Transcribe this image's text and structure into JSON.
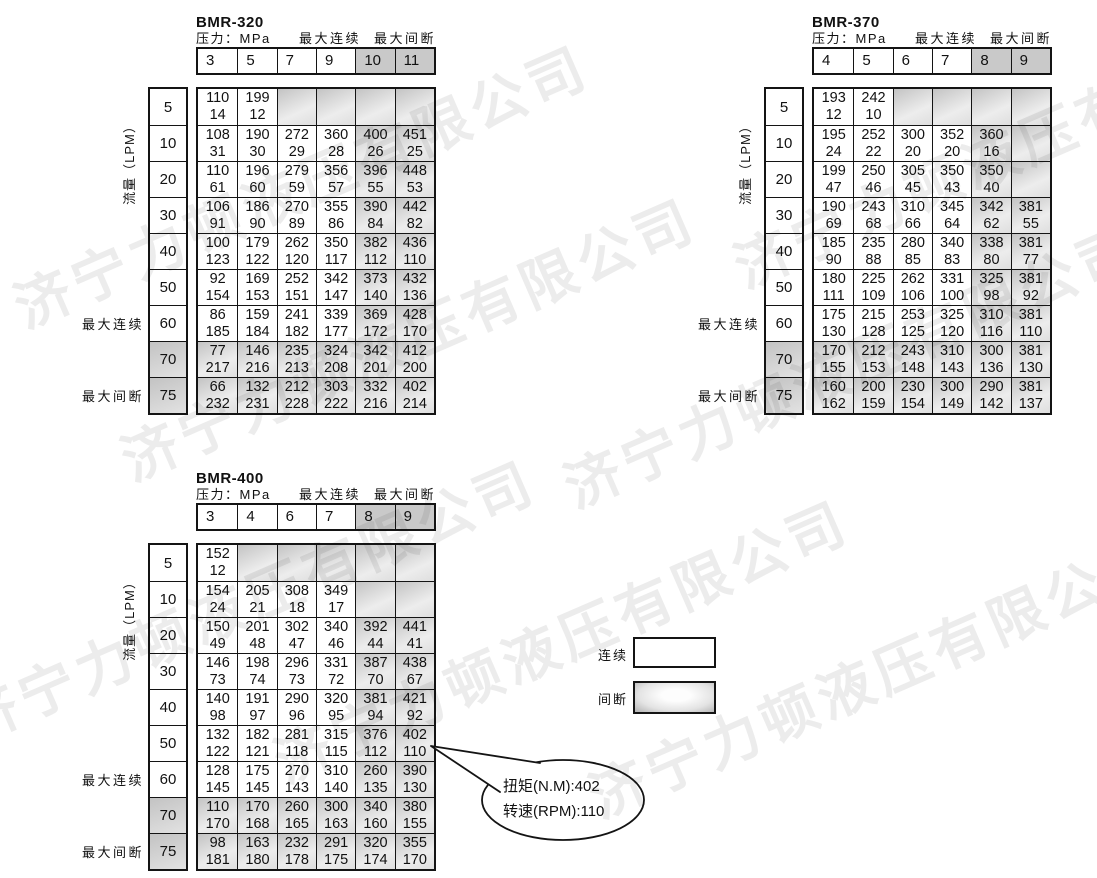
{
  "watermark": {
    "text": "济宁力顿液压有限公司"
  },
  "shared_labels": {
    "pressure_unit": "压力：MPa",
    "max_continuous": "最大连续",
    "max_intermittent": "最大间断",
    "flow_axis": "流量（LPM）"
  },
  "legend": {
    "continuous": "连续",
    "intermittent": "间断"
  },
  "callout": {
    "torque_line": "扭矩(N.M):402",
    "speed_line": "转速(RPM):110"
  },
  "tables": [
    {
      "title": "BMR-320",
      "pressure_columns": [
        "3",
        "5",
        "7",
        "9",
        "10",
        "11"
      ],
      "flow_rows": [
        "5",
        "10",
        "20",
        "30",
        "40",
        "50",
        "60",
        "70",
        "75"
      ],
      "shaded_columns_from": 4,
      "shaded_rows_from": 7,
      "cells": [
        [
          [
            "110",
            "14",
            0
          ],
          [
            "199",
            "12",
            0
          ],
          null,
          null,
          null,
          null
        ],
        [
          [
            "108",
            "31",
            0
          ],
          [
            "190",
            "30",
            0
          ],
          [
            "272",
            "29",
            0
          ],
          [
            "360",
            "28",
            0
          ],
          [
            "400",
            "26",
            1
          ],
          [
            "451",
            "25",
            1
          ]
        ],
        [
          [
            "110",
            "61",
            0
          ],
          [
            "196",
            "60",
            0
          ],
          [
            "279",
            "59",
            0
          ],
          [
            "356",
            "57",
            0
          ],
          [
            "396",
            "55",
            1
          ],
          [
            "448",
            "53",
            1
          ]
        ],
        [
          [
            "106",
            "91",
            0
          ],
          [
            "186",
            "90",
            0
          ],
          [
            "270",
            "89",
            0
          ],
          [
            "355",
            "86",
            0
          ],
          [
            "390",
            "84",
            1
          ],
          [
            "442",
            "82",
            1
          ]
        ],
        [
          [
            "100",
            "123",
            0
          ],
          [
            "179",
            "122",
            0
          ],
          [
            "262",
            "120",
            0
          ],
          [
            "350",
            "117",
            0
          ],
          [
            "382",
            "112",
            1
          ],
          [
            "436",
            "110",
            1
          ]
        ],
        [
          [
            "92",
            "154",
            0
          ],
          [
            "169",
            "153",
            0
          ],
          [
            "252",
            "151",
            0
          ],
          [
            "342",
            "147",
            0
          ],
          [
            "373",
            "140",
            1
          ],
          [
            "432",
            "136",
            1
          ]
        ],
        [
          [
            "86",
            "185",
            0
          ],
          [
            "159",
            "184",
            0
          ],
          [
            "241",
            "182",
            0
          ],
          [
            "339",
            "177",
            0
          ],
          [
            "369",
            "172",
            1
          ],
          [
            "428",
            "170",
            1
          ]
        ],
        [
          [
            "77",
            "217",
            1
          ],
          [
            "146",
            "216",
            1
          ],
          [
            "235",
            "213",
            1
          ],
          [
            "324",
            "208",
            1
          ],
          [
            "342",
            "201",
            1
          ],
          [
            "412",
            "200",
            1
          ]
        ],
        [
          [
            "66",
            "232",
            1
          ],
          [
            "132",
            "231",
            1
          ],
          [
            "212",
            "228",
            1
          ],
          [
            "303",
            "222",
            1
          ],
          [
            "332",
            "216",
            1
          ],
          [
            "402",
            "214",
            1
          ]
        ]
      ]
    },
    {
      "title": "BMR-370",
      "pressure_columns": [
        "4",
        "5",
        "6",
        "7",
        "8",
        "9"
      ],
      "flow_rows": [
        "5",
        "10",
        "20",
        "30",
        "40",
        "50",
        "60",
        "70",
        "75"
      ],
      "shaded_columns_from": 4,
      "shaded_rows_from": 7,
      "cells": [
        [
          [
            "193",
            "12",
            0
          ],
          [
            "242",
            "10",
            0
          ],
          null,
          null,
          null,
          null
        ],
        [
          [
            "195",
            "24",
            0
          ],
          [
            "252",
            "22",
            0
          ],
          [
            "300",
            "20",
            0
          ],
          [
            "352",
            "20",
            0
          ],
          [
            "360",
            "16",
            1
          ],
          null
        ],
        [
          [
            "199",
            "47",
            0
          ],
          [
            "250",
            "46",
            0
          ],
          [
            "305",
            "45",
            0
          ],
          [
            "350",
            "43",
            0
          ],
          [
            "350",
            "40",
            1
          ],
          null
        ],
        [
          [
            "190",
            "69",
            0
          ],
          [
            "243",
            "68",
            0
          ],
          [
            "310",
            "66",
            0
          ],
          [
            "345",
            "64",
            0
          ],
          [
            "342",
            "62",
            1
          ],
          [
            "381",
            "55",
            1
          ]
        ],
        [
          [
            "185",
            "90",
            0
          ],
          [
            "235",
            "88",
            0
          ],
          [
            "280",
            "85",
            0
          ],
          [
            "340",
            "83",
            0
          ],
          [
            "338",
            "80",
            1
          ],
          [
            "381",
            "77",
            1
          ]
        ],
        [
          [
            "180",
            "111",
            0
          ],
          [
            "225",
            "109",
            0
          ],
          [
            "262",
            "106",
            0
          ],
          [
            "331",
            "100",
            0
          ],
          [
            "325",
            "98",
            1
          ],
          [
            "381",
            "92",
            1
          ]
        ],
        [
          [
            "175",
            "130",
            0
          ],
          [
            "215",
            "128",
            0
          ],
          [
            "253",
            "125",
            0
          ],
          [
            "325",
            "120",
            0
          ],
          [
            "310",
            "116",
            1
          ],
          [
            "381",
            "110",
            1
          ]
        ],
        [
          [
            "170",
            "155",
            1
          ],
          [
            "212",
            "153",
            1
          ],
          [
            "243",
            "148",
            1
          ],
          [
            "310",
            "143",
            1
          ],
          [
            "300",
            "136",
            1
          ],
          [
            "381",
            "130",
            1
          ]
        ],
        [
          [
            "160",
            "162",
            1
          ],
          [
            "200",
            "159",
            1
          ],
          [
            "230",
            "154",
            1
          ],
          [
            "300",
            "149",
            1
          ],
          [
            "290",
            "142",
            1
          ],
          [
            "381",
            "137",
            1
          ]
        ]
      ]
    },
    {
      "title": "BMR-400",
      "pressure_columns": [
        "3",
        "4",
        "6",
        "7",
        "8",
        "9"
      ],
      "flow_rows": [
        "5",
        "10",
        "20",
        "30",
        "40",
        "50",
        "60",
        "70",
        "75"
      ],
      "shaded_columns_from": 4,
      "shaded_rows_from": 7,
      "cells": [
        [
          [
            "152",
            "12",
            0
          ],
          null,
          null,
          null,
          null,
          null
        ],
        [
          [
            "154",
            "24",
            0
          ],
          [
            "205",
            "21",
            0
          ],
          [
            "308",
            "18",
            0
          ],
          [
            "349",
            "17",
            0
          ],
          null,
          null
        ],
        [
          [
            "150",
            "49",
            0
          ],
          [
            "201",
            "48",
            0
          ],
          [
            "302",
            "47",
            0
          ],
          [
            "340",
            "46",
            0
          ],
          [
            "392",
            "44",
            1
          ],
          [
            "441",
            "41",
            1
          ]
        ],
        [
          [
            "146",
            "73",
            0
          ],
          [
            "198",
            "74",
            0
          ],
          [
            "296",
            "73",
            0
          ],
          [
            "331",
            "72",
            0
          ],
          [
            "387",
            "70",
            1
          ],
          [
            "438",
            "67",
            1
          ]
        ],
        [
          [
            "140",
            "98",
            0
          ],
          [
            "191",
            "97",
            0
          ],
          [
            "290",
            "96",
            0
          ],
          [
            "320",
            "95",
            0
          ],
          [
            "381",
            "94",
            1
          ],
          [
            "421",
            "92",
            1
          ]
        ],
        [
          [
            "132",
            "122",
            0
          ],
          [
            "182",
            "121",
            0
          ],
          [
            "281",
            "118",
            0
          ],
          [
            "315",
            "115",
            0
          ],
          [
            "376",
            "112",
            1
          ],
          [
            "402",
            "110",
            1
          ]
        ],
        [
          [
            "128",
            "145",
            0
          ],
          [
            "175",
            "145",
            0
          ],
          [
            "270",
            "143",
            0
          ],
          [
            "310",
            "140",
            0
          ],
          [
            "260",
            "135",
            1
          ],
          [
            "390",
            "130",
            1
          ]
        ],
        [
          [
            "110",
            "170",
            1
          ],
          [
            "170",
            "168",
            1
          ],
          [
            "260",
            "165",
            1
          ],
          [
            "300",
            "163",
            1
          ],
          [
            "340",
            "160",
            1
          ],
          [
            "380",
            "155",
            1
          ]
        ],
        [
          [
            "98",
            "181",
            1
          ],
          [
            "163",
            "180",
            1
          ],
          [
            "232",
            "178",
            1
          ],
          [
            "291",
            "175",
            1
          ],
          [
            "320",
            "174",
            1
          ],
          [
            "355",
            "170",
            1
          ]
        ]
      ]
    }
  ]
}
